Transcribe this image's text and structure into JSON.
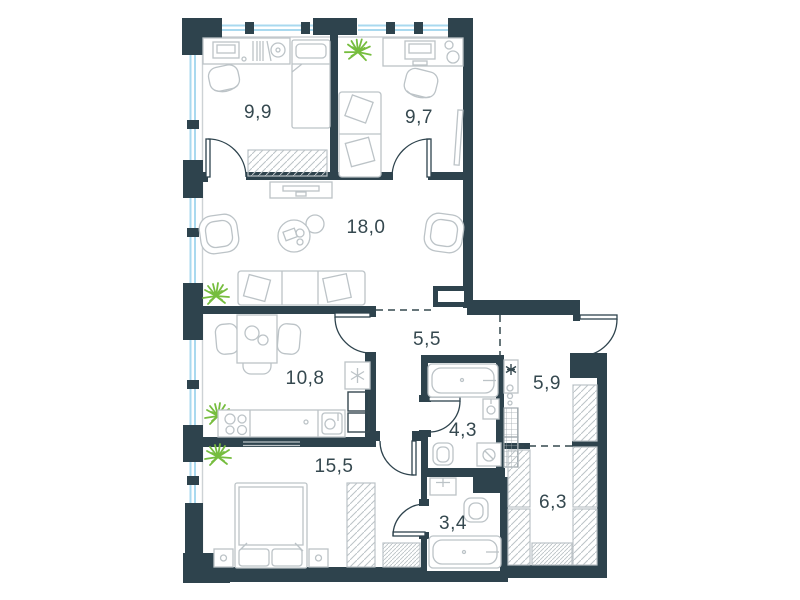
{
  "plan": {
    "type": "apartment-floor-plan",
    "rooms": [
      {
        "id": "bedroom-1",
        "area": "9,9"
      },
      {
        "id": "bedroom-2",
        "area": "9,7"
      },
      {
        "id": "living-room",
        "area": "18,0"
      },
      {
        "id": "corridor",
        "area": "5,5"
      },
      {
        "id": "kitchen-dining",
        "area": "10,8"
      },
      {
        "id": "entry-hall",
        "area": "5,9"
      },
      {
        "id": "bathroom-1",
        "area": "4,3"
      },
      {
        "id": "bedroom-3",
        "area": "15,5"
      },
      {
        "id": "bathroom-2",
        "area": "3,4"
      },
      {
        "id": "wardrobe-room",
        "area": "6,3"
      }
    ],
    "colors": {
      "wall": "#2e434d",
      "label": "#35484f",
      "furniture": "#bcc3c7",
      "window_glass": "#a9d9ef",
      "plant": "#76bd3e",
      "background": "#ffffff"
    }
  }
}
